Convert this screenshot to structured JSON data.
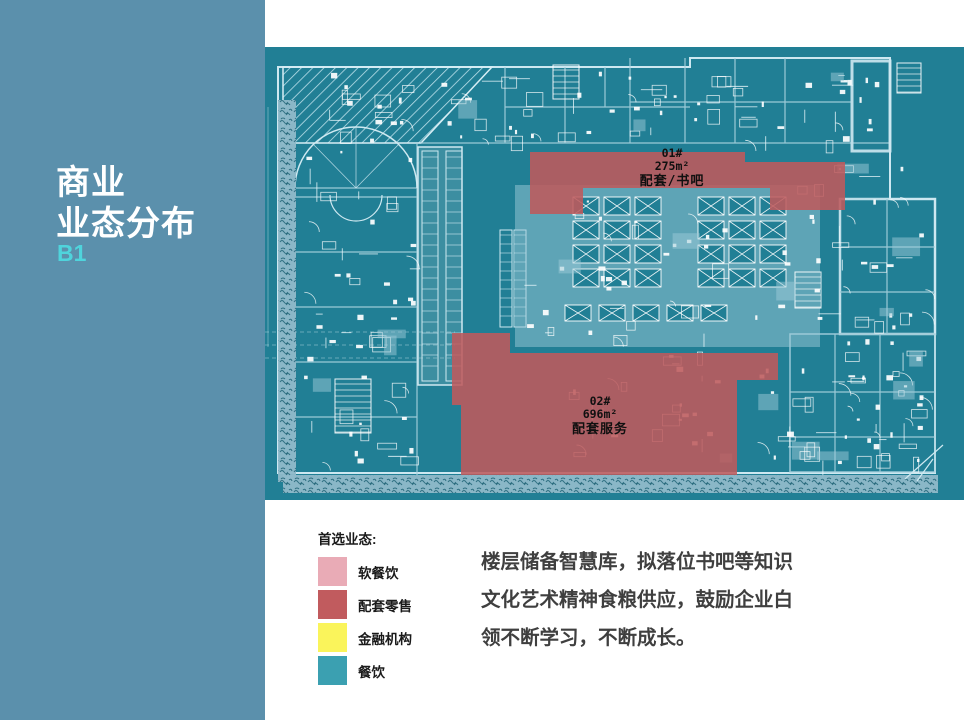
{
  "sidebar": {
    "title_line1": "商业",
    "title_line2": "业态分布",
    "floor_label": "B1"
  },
  "floorplan": {
    "regions": [
      {
        "id": "01#",
        "area": "275m²",
        "use": "配套/书吧"
      },
      {
        "id": "02#",
        "area": "696m²",
        "use": "配套服务"
      }
    ]
  },
  "legend": {
    "title": "首选业态:",
    "items": [
      {
        "label": "软餐饮",
        "color": "#E9ABB6"
      },
      {
        "label": "配套零售",
        "color": "#C15B5E"
      },
      {
        "label": "金融机构",
        "color": "#FAF45B"
      },
      {
        "label": "餐饮",
        "color": "#3BA0B1"
      }
    ]
  },
  "description_lines": [
    "楼层储备智慧库，拟落位书吧等知识",
    "文化艺术精神食粮供应，鼓励企业白",
    "领不断学习，不断成长。"
  ],
  "colors": {
    "sidebar_bg": "#5B90AC",
    "plan_bg": "#217F95",
    "highlight_red": "#BE5A5C",
    "accent_cyan": "#4FD4DC"
  }
}
